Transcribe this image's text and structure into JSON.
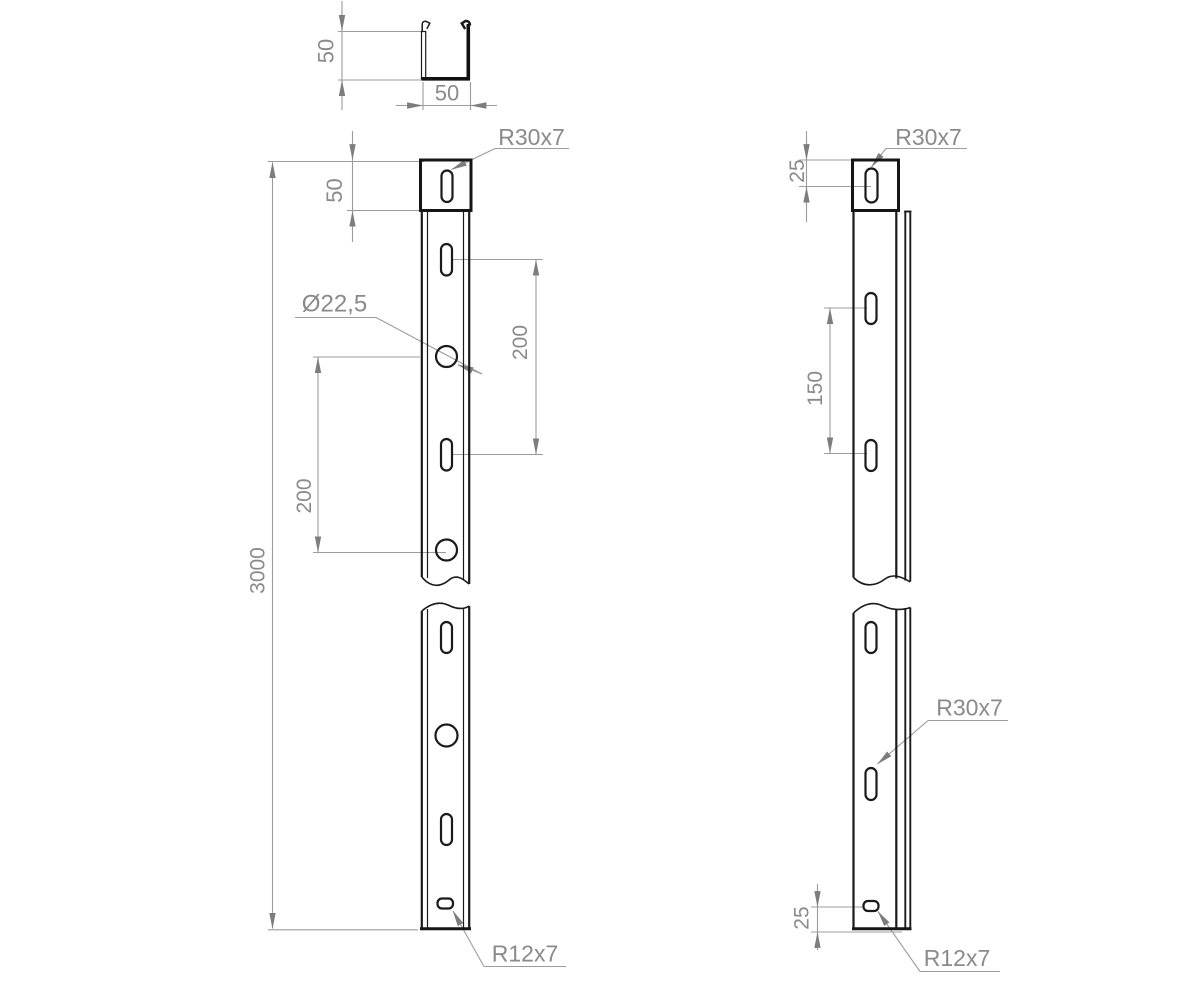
{
  "drawing": {
    "type": "technical-drawing-perforated-channel",
    "section_view": {
      "height_dim": "50",
      "width_dim": "50"
    },
    "front_view": {
      "top_hole_offset_dim": "50",
      "total_length_dim": "3000",
      "upper_spacing_dim": "200",
      "lower_spacing_dim": "200",
      "hole_diameter_label": "Ø22,5",
      "top_slot_label": "R30x7",
      "bottom_slot_label": "R12x7"
    },
    "side_view": {
      "top_hole_offset_dim": "25",
      "hole_spacing_dim": "150",
      "top_slot_label": "R30x7",
      "mid_slot_label": "R30x7",
      "bottom_hole_offset_dim": "25",
      "bottom_slot_label": "R12x7"
    },
    "colors": {
      "background": "#ffffff",
      "outline": "#1a1a1a",
      "dimension_line": "#9c9c9c",
      "dimension_text": "#8a8a8a",
      "arrowhead": "#7d7d7d"
    }
  }
}
